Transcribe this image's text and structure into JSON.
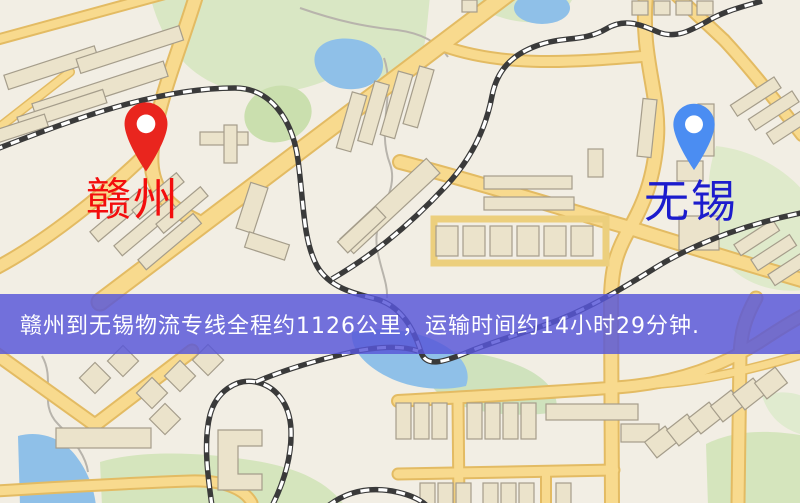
{
  "banner": {
    "text": "赣州到无锡物流专线全程约1126公里，运输时间约14小时29分钟.",
    "background_color": "#5857d8",
    "text_color": "#ffffff",
    "distance_text": "约1126公里",
    "duration_text": "约14小时29分钟"
  },
  "markers": {
    "origin": {
      "label": "赣州",
      "icon": "map-pin",
      "pin_color": "#e9251e",
      "label_color": "#f30d0d"
    },
    "destination": {
      "label": "无锡",
      "icon": "map-pin",
      "pin_color": "#4b8df2",
      "label_color": "#1c1ccd"
    }
  },
  "map": {
    "style": {
      "background": "#f2eee4",
      "road": "#f8da8e",
      "road_casing": "#e3bb63",
      "building": "#ebe3cb",
      "building_outline": "#a59d8b",
      "park": "#d9e7c4",
      "water": "#8fc0e8",
      "railway": "#3a3a3a"
    }
  }
}
